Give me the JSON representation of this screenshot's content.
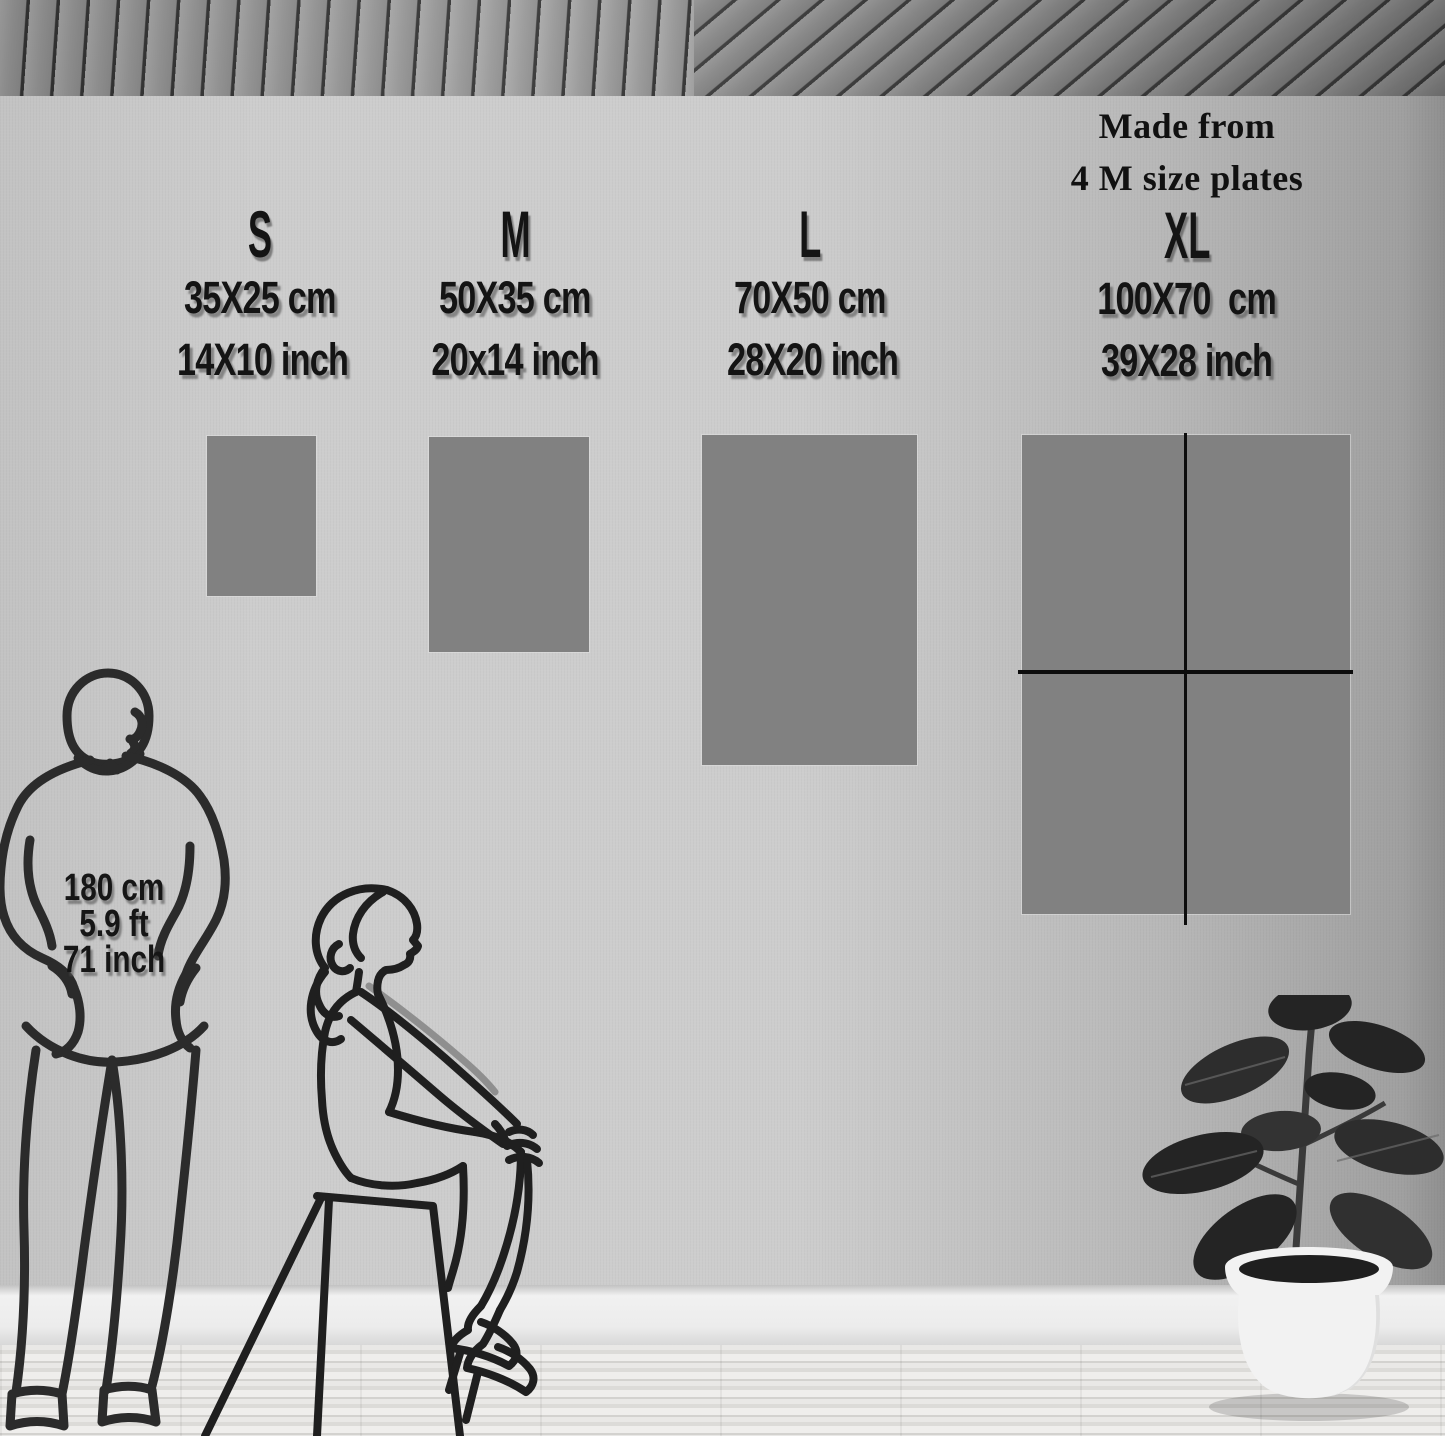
{
  "scene_title": "Poster size comparison wall mockup",
  "sizes": [
    {
      "label": "S",
      "cm": "35X25 cm",
      "inch": "14X10 inch"
    },
    {
      "label": "M",
      "cm": "50X35 cm",
      "inch": "20x14 inch"
    },
    {
      "label": "L",
      "cm": "70X50 cm",
      "inch": "28X20 inch"
    },
    {
      "label": "XL",
      "cm": "100X70  cm",
      "inch": "39X28 inch",
      "note_lines": [
        "Made from",
        "4 M size plates"
      ]
    }
  ],
  "person": {
    "height_cm": "180 cm",
    "height_ft": "5.9 ft",
    "height_in": "71 inch"
  },
  "colors": {
    "wall": "#cdcdcd",
    "panel_grey": "#818181",
    "text": "#141414",
    "divider_line": "#0d0d0d",
    "ceiling_gap": "#3d3d3d",
    "baseboard": "#ececec",
    "floor": "#e9e8e6",
    "pot": "#f2f2f2",
    "leaf": "#242424",
    "figure_line": "#2b2b2b"
  }
}
